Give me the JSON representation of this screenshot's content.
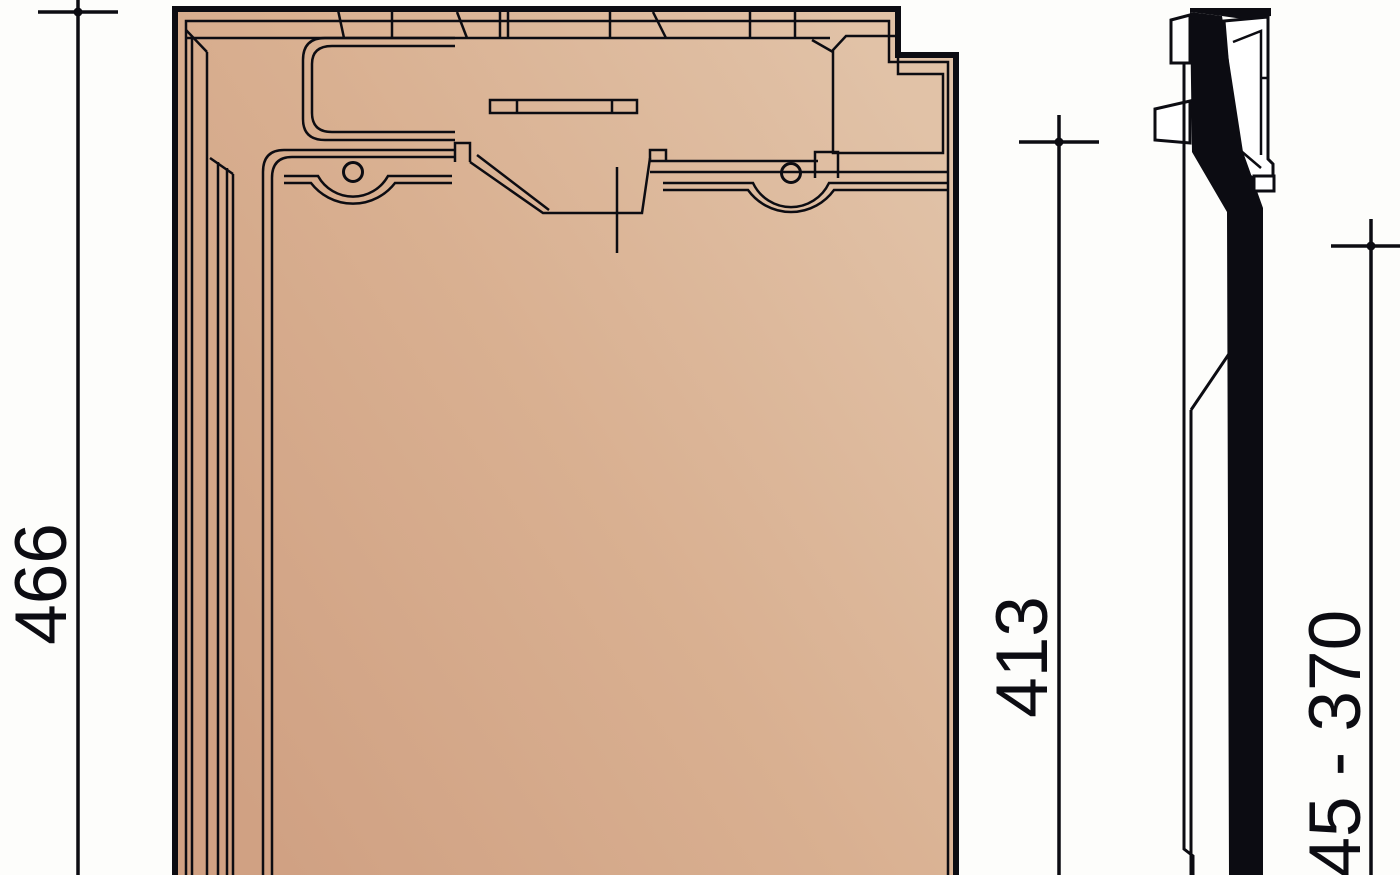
{
  "drawing": {
    "type": "technical-drawing",
    "subject": "roof-tile",
    "views": {
      "front_view": "tile-front-elevation",
      "side_view": "tile-side-profile-section"
    },
    "dimensions": {
      "overall_length": {
        "value": "466"
      },
      "cover_length": {
        "value": "413"
      },
      "batten_range": {
        "value": "345 - 370"
      }
    },
    "colors": {
      "background": "#fdfdfb",
      "line": "#0c0c12",
      "tile_dark": "#d0a183",
      "tile_mid": "#d9b091",
      "tile_light": "#e1c2a7",
      "section_fill": "#0c0c12"
    }
  }
}
